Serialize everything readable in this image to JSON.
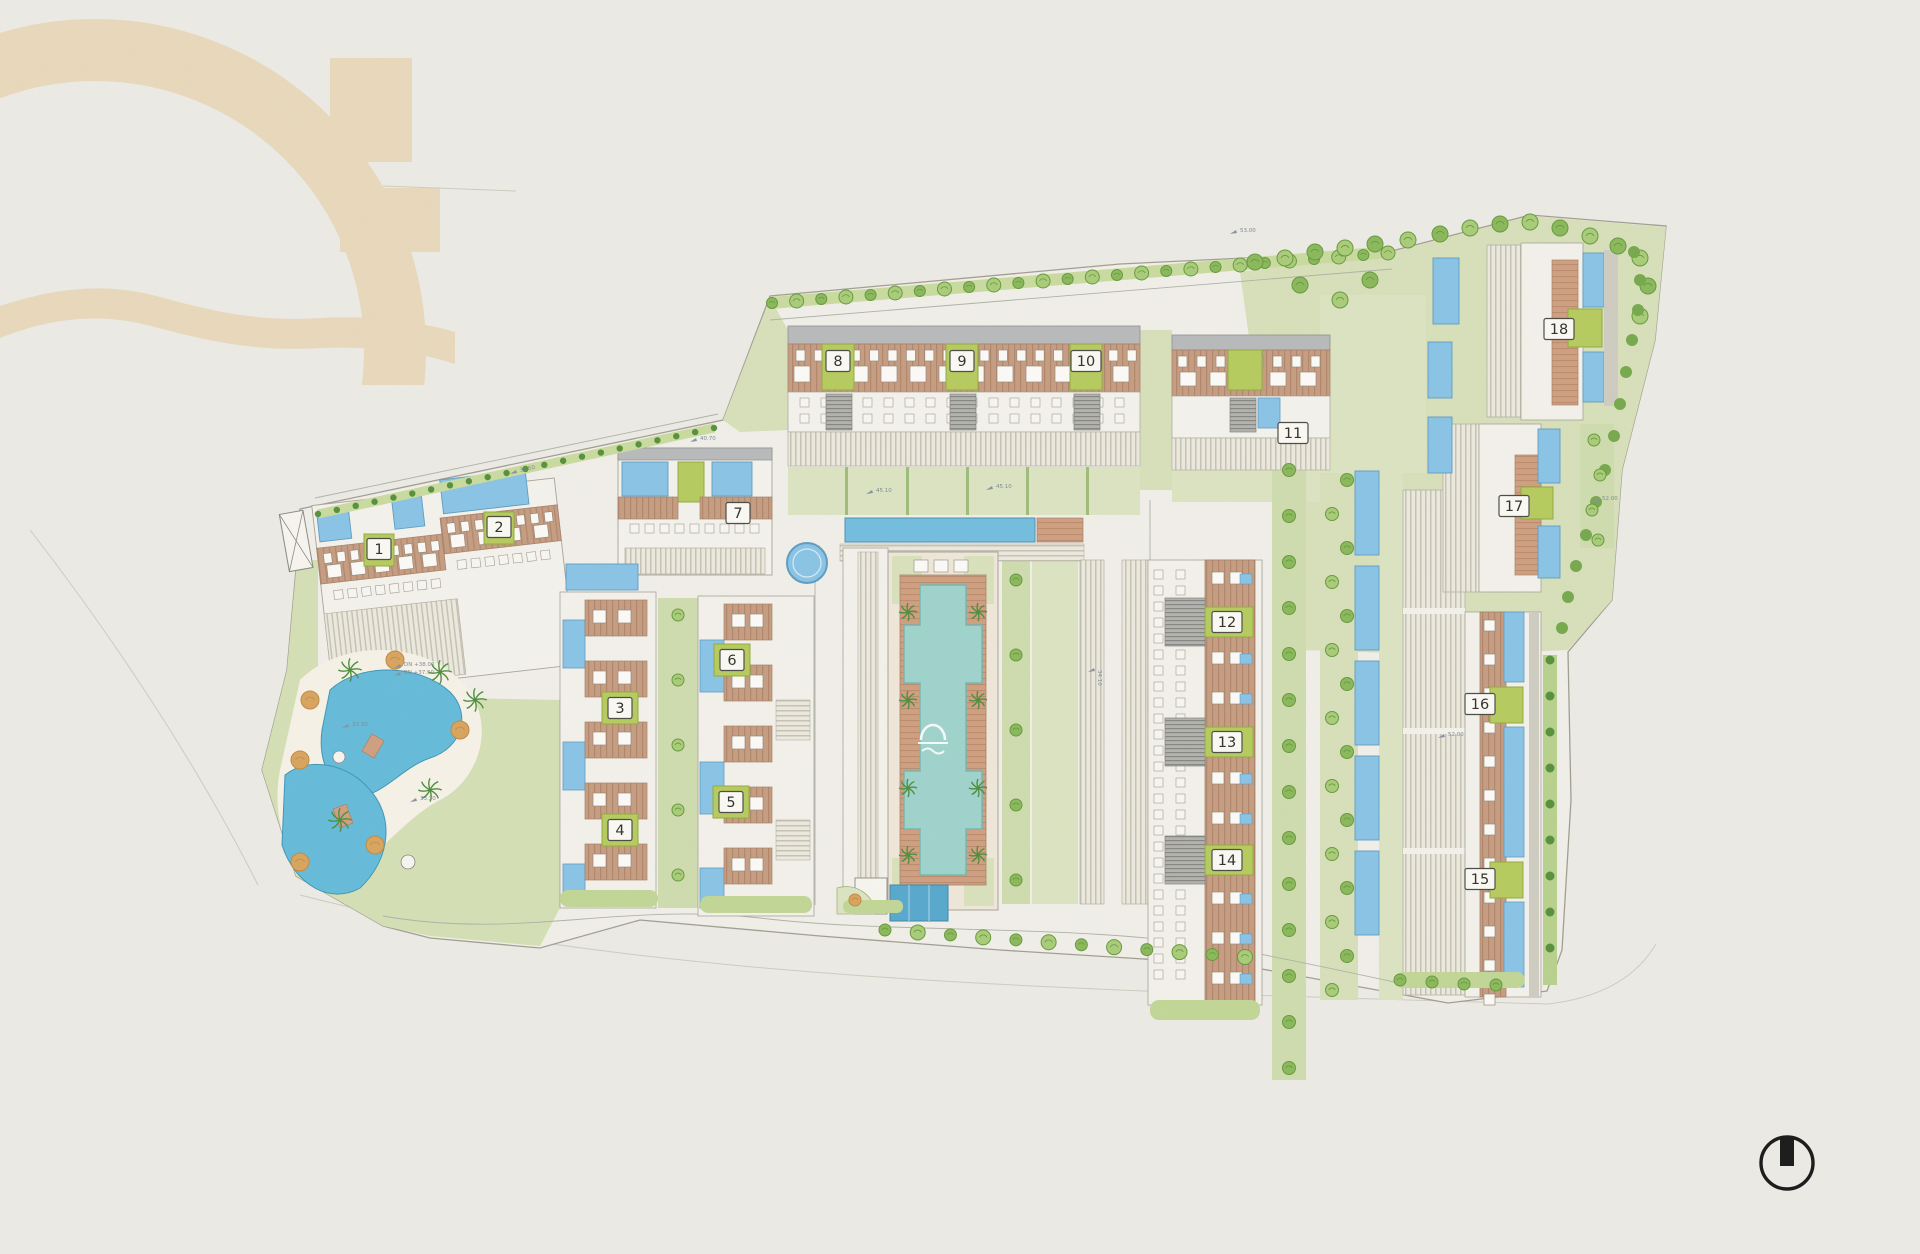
{
  "document": {
    "kind": "architectural site plan drawing",
    "visible_text_note": "plan shows numbered building badges 1-18, small surveyor level labels, a brand watermark and a north indicator"
  },
  "buildings": [
    {
      "label": "1",
      "x": 379,
      "y": 549
    },
    {
      "label": "2",
      "x": 499,
      "y": 527
    },
    {
      "label": "3",
      "x": 620,
      "y": 708
    },
    {
      "label": "4",
      "x": 620,
      "y": 830
    },
    {
      "label": "5",
      "x": 731,
      "y": 802
    },
    {
      "label": "6",
      "x": 732,
      "y": 660
    },
    {
      "label": "7",
      "x": 738,
      "y": 513
    },
    {
      "label": "8",
      "x": 838,
      "y": 361
    },
    {
      "label": "9",
      "x": 962,
      "y": 361
    },
    {
      "label": "10",
      "x": 1086,
      "y": 361
    },
    {
      "label": "11",
      "x": 1293,
      "y": 433
    },
    {
      "label": "12",
      "x": 1227,
      "y": 622
    },
    {
      "label": "13",
      "x": 1227,
      "y": 742
    },
    {
      "label": "14",
      "x": 1227,
      "y": 860
    },
    {
      "label": "15",
      "x": 1480,
      "y": 879
    },
    {
      "label": "16",
      "x": 1480,
      "y": 704
    },
    {
      "label": "17",
      "x": 1514,
      "y": 506
    },
    {
      "label": "18",
      "x": 1559,
      "y": 329
    }
  ],
  "annotations": [
    {
      "text": "45.10",
      "x": 876,
      "y": 492,
      "rot": 0
    },
    {
      "text": "45.10",
      "x": 996,
      "y": 488,
      "rot": 0
    },
    {
      "text": "37.50",
      "x": 520,
      "y": 472,
      "rot": -12
    },
    {
      "text": "DN +38.00",
      "x": 404,
      "y": 666,
      "rot": 0
    },
    {
      "text": "BN +37.50",
      "x": 404,
      "y": 674,
      "rot": 0
    },
    {
      "text": "33.30",
      "x": 352,
      "y": 726,
      "rot": 0
    },
    {
      "text": "33.30",
      "x": 420,
      "y": 800,
      "rot": 0
    },
    {
      "text": "40.70",
      "x": 700,
      "y": 440,
      "rot": 0
    },
    {
      "text": "53.00",
      "x": 1240,
      "y": 232,
      "rot": 0
    },
    {
      "text": "52.00",
      "x": 1602,
      "y": 500,
      "rot": 0
    },
    {
      "text": "52.00",
      "x": 1448,
      "y": 736,
      "rot": 0
    },
    {
      "text": "34.10",
      "x": 1098,
      "y": 670,
      "rot": 90
    }
  ],
  "icons": {
    "north_indicator": "circle with filled north bar",
    "brand_watermark": "dome arch with wave, paper tan",
    "pool_logo": "white dome arch with wave inside main pool"
  },
  "colors": {
    "paper": "#ecebe5",
    "ground": "#f1efe9",
    "watermark-tan": "#e9d8bc",
    "lawn": "#d7e0ba",
    "lawn-bright": "#cfdcae",
    "lawn-pale": "#dce4c2",
    "hedge": "#c2d697",
    "lime": "#b6cb5f",
    "lime-edge": "#94ab41",
    "tree-green": "#8cb95c",
    "tree-light": "#a9cc79",
    "tree-dark": "#679a3f",
    "shrub": "#59913c",
    "pool-blue": "#8ac4e6",
    "pool-edge": "#5f9dc2",
    "pool-long": "#74bede",
    "pool-teal": "#9fd3cc",
    "pool-deep": "#58a9cd",
    "lagoon": "#66bcd9",
    "roof-brown": "#c59d82",
    "deck": "#cf9f80",
    "roof-gray": "#b9babb",
    "line-gray": "#a39e92",
    "badge-bg": "#faf9f4",
    "badge-border": "#4d4c45",
    "ink": "#1b1b1b"
  }
}
